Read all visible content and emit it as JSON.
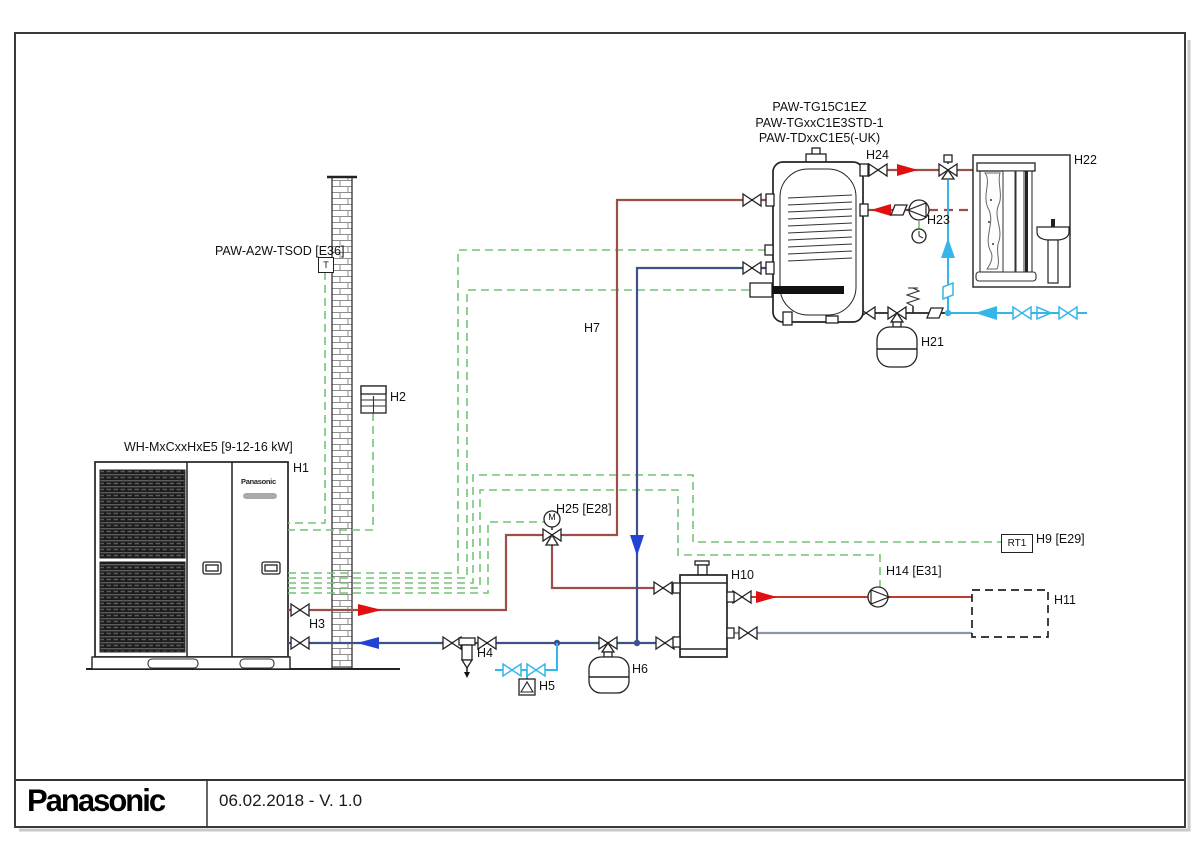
{
  "title_block": {
    "brand": "Panasonic",
    "date_version": "06.02.2018 - V. 1.0"
  },
  "labels": {
    "hp_model": "WH-MxCxxHxE5 [9-12-16 kW]",
    "unit_brand": "Panasonic",
    "h1": "H1",
    "outdoor_sensor": "PAW-A2W-TSOD [E36]",
    "t_symbol": "T",
    "h2": "H2",
    "h3": "H3",
    "h4": "H4",
    "h5": "H5",
    "h6": "H6",
    "h7": "H7",
    "h9": "H9 [E29]",
    "rt1": "RT1",
    "h10": "H10",
    "h11": "H11",
    "h14": "H14 [E31]",
    "h21": "H21",
    "h22": "H22",
    "h23": "H23",
    "h24": "H24",
    "h25": "H25 [E28]",
    "m_actuator": "M",
    "tank_model_1": "PAW-TG15C1EZ",
    "tank_model_2": "PAW-TGxxC1E3STD-1",
    "tank_model_3": "PAW-TDxxC1E5(-UK)"
  },
  "colors": {
    "heating_dark": "#9a5048",
    "heating_bright": "#c0392b",
    "arrow_red": "#e01010",
    "return_blue": "#3f5189",
    "arrow_blue": "#2343d7",
    "cold_cyan": "#35b6e9",
    "cable_green": "#74c474",
    "return_gray": "#8a97a6"
  }
}
